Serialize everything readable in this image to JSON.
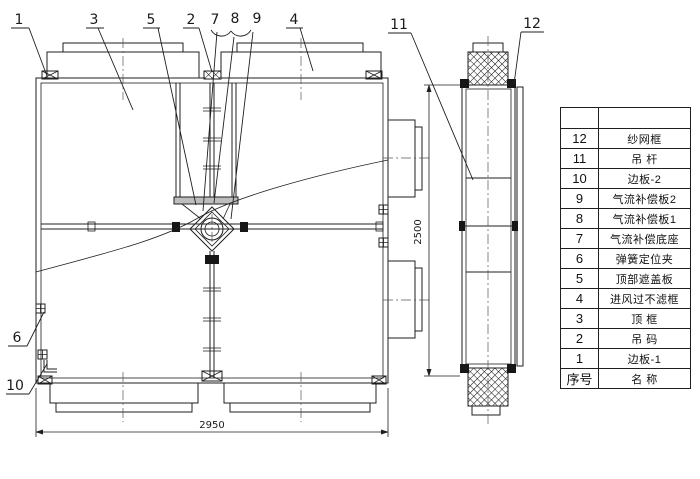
{
  "callouts": [
    "1",
    "3",
    "5",
    "2",
    "7",
    "8",
    "9",
    "4",
    "11",
    "12",
    "6",
    "10"
  ],
  "dimensions": {
    "width": "2950",
    "height": "2500"
  },
  "parts_table": {
    "rows": [
      {
        "no": "",
        "name": ""
      },
      {
        "no": "12",
        "name": "纱网框"
      },
      {
        "no": "11",
        "name": "吊 杆"
      },
      {
        "no": "10",
        "name": "边板-2"
      },
      {
        "no": "9",
        "name": "气流补偿板2"
      },
      {
        "no": "8",
        "name": "气流补偿板1"
      },
      {
        "no": "7",
        "name": "气流补偿底座"
      },
      {
        "no": "6",
        "name": "弹簧定位夹"
      },
      {
        "no": "5",
        "name": "顶部遮盖板"
      },
      {
        "no": "4",
        "name": "进风过不滤框"
      },
      {
        "no": "3",
        "name": "顶 框"
      },
      {
        "no": "2",
        "name": "吊 码"
      },
      {
        "no": "1",
        "name": "边板-1"
      }
    ],
    "footer": {
      "no": "序号",
      "name": "名 称"
    }
  }
}
